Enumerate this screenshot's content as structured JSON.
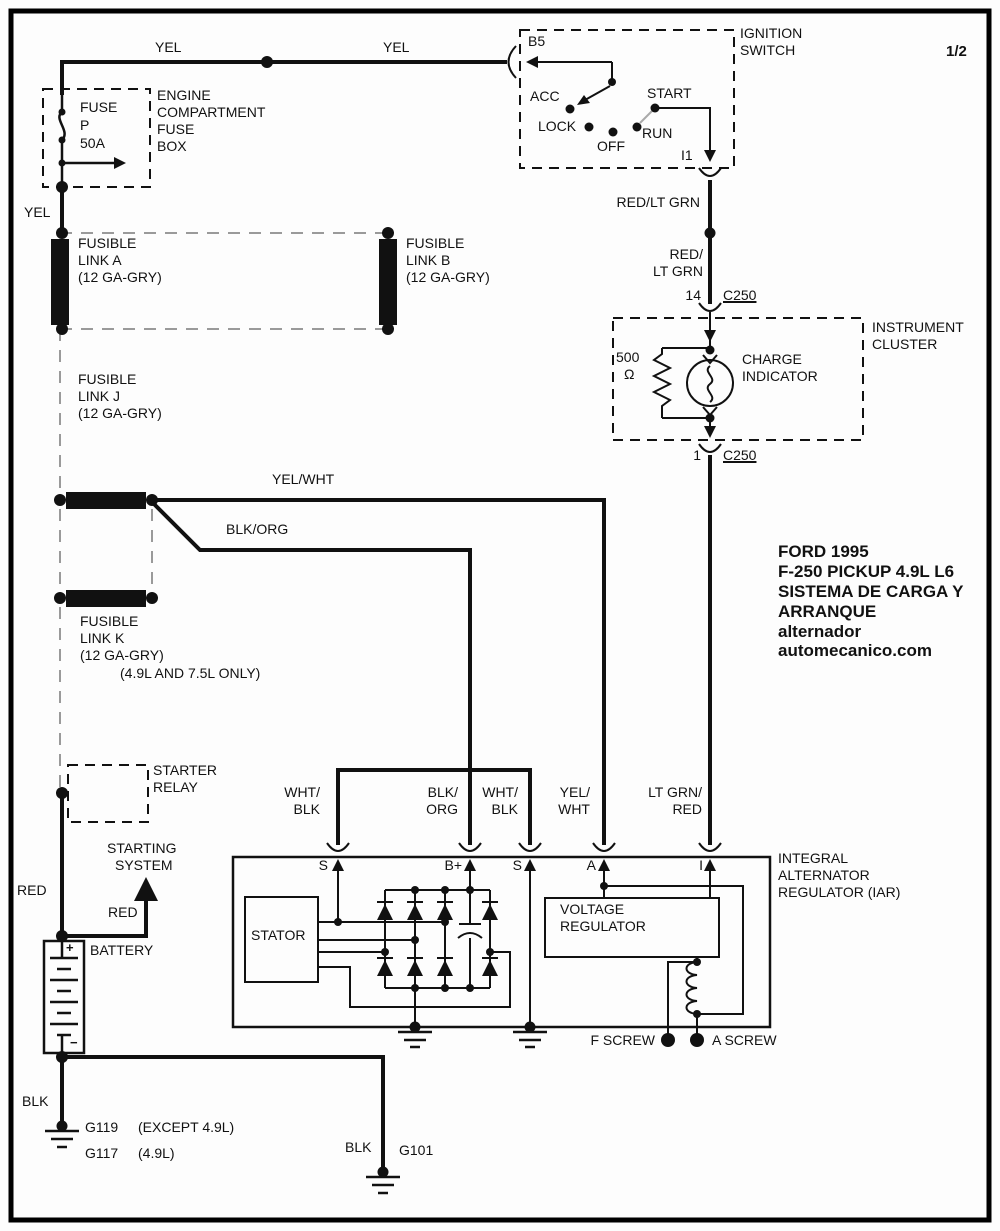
{
  "page": {
    "number": "1/2"
  },
  "top": {
    "yel_left": "YEL",
    "yel_right": "YEL",
    "yel_vert": "YEL"
  },
  "fuse_box": {
    "name_l1": "ENGINE",
    "name_l2": "COMPARTMENT",
    "name_l3": "FUSE",
    "name_l4": "BOX",
    "fuse": "FUSE",
    "fuse_id": "P",
    "rating": "50A"
  },
  "ignition": {
    "title_l1": "IGNITION",
    "title_l2": "SWITCH",
    "b5": "B5",
    "acc": "ACC",
    "lock": "LOCK",
    "off": "OFF",
    "run": "RUN",
    "start": "START",
    "i1": "I1"
  },
  "wire_red_ltgrn": {
    "label": "RED/LT GRN",
    "label2_l1": "RED/",
    "label2_l2": "LT GRN"
  },
  "c250_top": {
    "pin": "14",
    "conn": "C250"
  },
  "c250_bottom": {
    "pin": "1",
    "conn": "C250"
  },
  "cluster": {
    "title_l1": "INSTRUMENT",
    "title_l2": "CLUSTER",
    "res_val": "500",
    "res_unit": "Ω",
    "ind_l1": "CHARGE",
    "ind_l2": "INDICATOR"
  },
  "links": {
    "a_l1": "FUSIBLE",
    "a_l2": "LINK A",
    "a_l3": "(12 GA-GRY)",
    "b_l1": "FUSIBLE",
    "b_l2": "LINK B",
    "b_l3": "(12 GA-GRY)",
    "j_l1": "FUSIBLE",
    "j_l2": "LINK J",
    "j_l3": "(12 GA-GRY)",
    "k_l1": "FUSIBLE",
    "k_l2": "LINK K",
    "k_l3": "(12 GA-GRY)",
    "k_note": "(4.9L AND 7.5L ONLY)"
  },
  "mid_wires": {
    "yel_wht": "YEL/WHT",
    "blk_org": "BLK/ORG"
  },
  "title_block": {
    "l1": "FORD 1995",
    "l2": "F-250 PICKUP 4.9L L6",
    "l3": "SISTEMA DE CARGA Y",
    "l4": "ARRANQUE",
    "l5": "alternador",
    "l6": "automecanico.com"
  },
  "starter_relay": {
    "l1": "STARTER",
    "l2": "RELAY"
  },
  "starting_system": {
    "l1": "STARTING",
    "l2": "SYSTEM",
    "red": "RED"
  },
  "battery": {
    "label": "BATTERY",
    "red": "RED",
    "plus": "+",
    "minus": "−"
  },
  "iar": {
    "title_l1": "INTEGRAL",
    "title_l2": "ALTERNATOR",
    "title_l3": "REGULATOR (IAR)",
    "stator": "STATOR",
    "vr_l1": "VOLTAGE",
    "vr_l2": "REGULATOR",
    "f_screw": "F SCREW",
    "a_screw": "A SCREW",
    "t_s1": "S",
    "t_bplus": "B+",
    "t_s2": "S",
    "t_a": "A",
    "t_i": "I",
    "w_s1_l1": "WHT/",
    "w_s1_l2": "BLK",
    "w_b_l1": "BLK/",
    "w_b_l2": "ORG",
    "w_s2_l1": "WHT/",
    "w_s2_l2": "BLK",
    "w_a_l1": "YEL/",
    "w_a_l2": "WHT",
    "w_i_l1": "LT GRN/",
    "w_i_l2": "RED"
  },
  "grounds": {
    "blk_left": "BLK",
    "g119": "G119",
    "g119_note": "(EXCEPT 4.9L)",
    "g117": "G117",
    "g117_note": "(4.9L)",
    "blk_right": "BLK",
    "g101": "G101"
  },
  "colors": {
    "line": "#111111",
    "dash_gray": "#9a9a9a",
    "bg": "#fdfdfd"
  }
}
